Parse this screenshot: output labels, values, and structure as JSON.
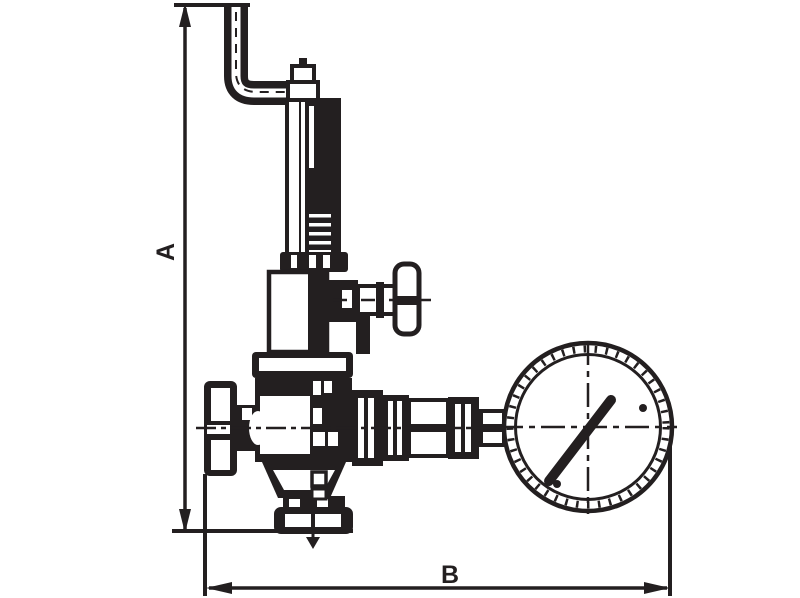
{
  "figure": {
    "kind": "technical line drawing",
    "subject": "spring safety valve with bent vent pipe and pressure gauge"
  },
  "dimensions": {
    "vertical_label": "A",
    "horizontal_label": "B"
  },
  "colors": {
    "ink": "#231f20",
    "background": "#ffffff"
  }
}
